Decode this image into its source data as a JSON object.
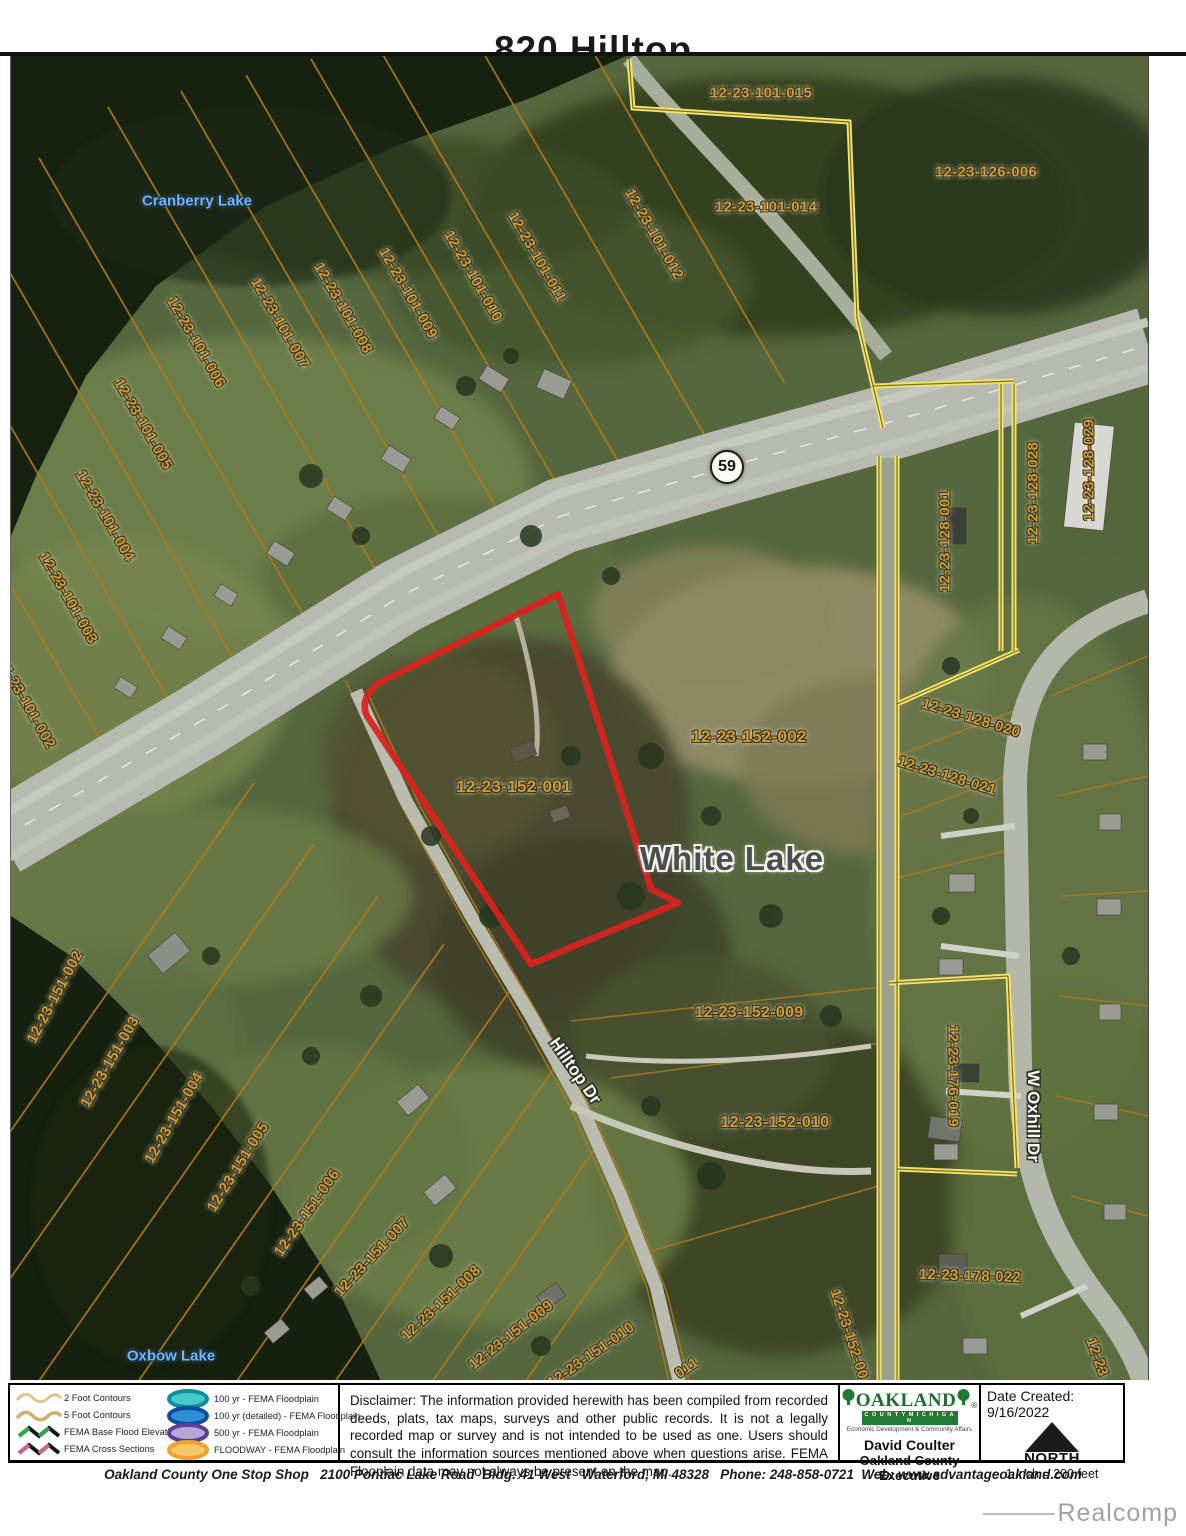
{
  "title": "820 Hilltop",
  "watermark": "Realcomp",
  "colors": {
    "highlight_outline": "#d8231d",
    "parcel_line": "#b07a1d",
    "boundary_yellow": "#f2e26e",
    "parcel_label": "#c89c42",
    "contour_2ft": "#dcc58c",
    "contour_5ft": "#d2b06a",
    "fema_base_flood": "#31a24f",
    "fema_cross_section": "#d06488",
    "floodplain_100yr": "#49c8cc",
    "floodplain_100yr_ring": "#0e8fa0",
    "floodplain_100yr_detailed": "#2f8fd4",
    "floodplain_100yr_detailed_ring": "#0c4da0",
    "floodplain_500yr": "#b4a6d6",
    "floodplain_500yr_ring": "#5a3d99",
    "floodway": "#f7c86a",
    "floodway_ring": "#f0a22c"
  },
  "map": {
    "route_shield": "59",
    "highlighted_parcel": "12-23-152-001",
    "labels": [
      {
        "kind": "parcel",
        "text": "12-23-101-015",
        "x": 750,
        "y": 37,
        "rot": 0
      },
      {
        "kind": "parcel",
        "text": "12-23-101-014",
        "x": 755,
        "y": 151,
        "rot": 0
      },
      {
        "kind": "parcel",
        "text": "12-23-126-006",
        "x": 975,
        "y": 116,
        "rot": 0
      },
      {
        "kind": "parcel",
        "text": "12-23-101-012",
        "x": 643,
        "y": 178,
        "rot": 60
      },
      {
        "kind": "parcel",
        "text": "12-23-101-011",
        "x": 526,
        "y": 201,
        "rot": 60
      },
      {
        "kind": "parcel",
        "text": "12-23-101-010",
        "x": 462,
        "y": 220,
        "rot": 60
      },
      {
        "kind": "parcel",
        "text": "12-23-101-009",
        "x": 397,
        "y": 237,
        "rot": 60
      },
      {
        "kind": "parcel",
        "text": "12-23-101-008",
        "x": 332,
        "y": 252,
        "rot": 60
      },
      {
        "kind": "parcel",
        "text": "12-23-101-007",
        "x": 269,
        "y": 267,
        "rot": 60
      },
      {
        "kind": "parcel",
        "text": "12-23-101-006",
        "x": 185,
        "y": 286,
        "rot": 60
      },
      {
        "kind": "parcel",
        "text": "12-23-101-005",
        "x": 132,
        "y": 368,
        "rot": 60
      },
      {
        "kind": "parcel",
        "text": "12-23-101-004",
        "x": 94,
        "y": 460,
        "rot": 60
      },
      {
        "kind": "parcel",
        "text": "12-23-101-003",
        "x": 57,
        "y": 542,
        "rot": 60
      },
      {
        "kind": "parcel",
        "text": "12-23-101-002",
        "x": 15,
        "y": 647,
        "rot": 60
      },
      {
        "kind": "parcel",
        "text": "12-23-152-001",
        "x": 503,
        "y": 731,
        "rot": 0,
        "size": 17
      },
      {
        "kind": "parcel",
        "text": "12-23-152-002",
        "x": 738,
        "y": 681,
        "rot": 0,
        "size": 17
      },
      {
        "kind": "parcel",
        "text": "12-23-152-009",
        "x": 738,
        "y": 957,
        "rot": 0,
        "size": 16
      },
      {
        "kind": "parcel",
        "text": "12-23-152-010",
        "x": 764,
        "y": 1067,
        "rot": 0,
        "size": 16
      },
      {
        "kind": "parcel",
        "text": "12-23-152-00",
        "x": 838,
        "y": 1278,
        "rot": 72
      },
      {
        "kind": "parcel",
        "text": "12-23-151-002",
        "x": 44,
        "y": 941,
        "rot": -62
      },
      {
        "kind": "parcel",
        "text": "12-23-151-003",
        "x": 99,
        "y": 1006,
        "rot": -60
      },
      {
        "kind": "parcel",
        "text": "12-23-151-004",
        "x": 163,
        "y": 1062,
        "rot": -60
      },
      {
        "kind": "parcel",
        "text": "12-23-151-005",
        "x": 227,
        "y": 1111,
        "rot": -58
      },
      {
        "kind": "parcel",
        "text": "12-23-151-006",
        "x": 296,
        "y": 1157,
        "rot": -55
      },
      {
        "kind": "parcel",
        "text": "12-23-151-007",
        "x": 361,
        "y": 1201,
        "rot": -47
      },
      {
        "kind": "parcel",
        "text": "12-23-151-008",
        "x": 430,
        "y": 1247,
        "rot": -43
      },
      {
        "kind": "parcel",
        "text": "12-23-151-009",
        "x": 500,
        "y": 1279,
        "rot": -38
      },
      {
        "kind": "parcel",
        "text": "12-23-151-010",
        "x": 580,
        "y": 1299,
        "rot": -35
      },
      {
        "kind": "parcel",
        "text": "011",
        "x": 676,
        "y": 1312,
        "rot": -35
      },
      {
        "kind": "parcel",
        "text": "12-23-128-001",
        "x": 934,
        "y": 485,
        "rot": -90
      },
      {
        "kind": "parcel",
        "text": "12-23-128-028",
        "x": 1022,
        "y": 437,
        "rot": -90
      },
      {
        "kind": "parcel",
        "text": "12-23-128-029",
        "x": 1078,
        "y": 414,
        "rot": -90
      },
      {
        "kind": "parcel",
        "text": "12-23-128-020",
        "x": 960,
        "y": 662,
        "rot": 17
      },
      {
        "kind": "parcel",
        "text": "12-23-128-021",
        "x": 936,
        "y": 720,
        "rot": 17
      },
      {
        "kind": "parcel",
        "text": "12-23-176-019",
        "x": 942,
        "y": 1020,
        "rot": 90
      },
      {
        "kind": "parcel",
        "text": "12-23-178-022",
        "x": 959,
        "y": 1220,
        "rot": 2
      },
      {
        "kind": "parcel",
        "text": "12-23",
        "x": 1086,
        "y": 1301,
        "rot": 70
      },
      {
        "kind": "lake",
        "text": "Cranberry Lake",
        "x": 186,
        "y": 145,
        "rot": 0
      },
      {
        "kind": "lake",
        "text": "Oxbow Lake",
        "x": 160,
        "y": 1300,
        "rot": 0
      },
      {
        "kind": "road",
        "text": "Hilltop Dr",
        "x": 564,
        "y": 1015,
        "rot": 55
      },
      {
        "kind": "road",
        "text": "W Oxhill Dr",
        "x": 1022,
        "y": 1060,
        "rot": 90
      },
      {
        "kind": "place",
        "text": "White Lake",
        "x": 721,
        "y": 803,
        "rot": 0,
        "size": 33
      }
    ]
  },
  "legend": {
    "left": [
      {
        "label": "2 Foot Contours",
        "swatch": "contour-2ft"
      },
      {
        "label": "5 Foot Contours",
        "swatch": "contour-5ft"
      },
      {
        "label": "FEMA Base Flood Elevations",
        "swatch": "zigzag-green"
      },
      {
        "label": "FEMA Cross Sections",
        "swatch": "zigzag-pink"
      }
    ],
    "right": [
      {
        "label": "100 yr - FEMA Floodplain",
        "swatch": "ellipse-teal"
      },
      {
        "label": "100 yr (detailed) - FEMA Floodplain",
        "swatch": "ellipse-blue"
      },
      {
        "label": "500 yr - FEMA Floodplain",
        "swatch": "ellipse-purple"
      },
      {
        "label": "FLOODWAY - FEMA Floodplain",
        "swatch": "ellipse-orange"
      }
    ]
  },
  "disclaimer": "Disclaimer:  The information provided herewith has been compiled from recorded deeds, plats, tax maps, surveys and other public records.  It is not a legally recorded map or survey and is not intended to be used as one.  Users should consult the information sources mentioned above when questions arise. FEMA Flooplain data may not always be present on the map.",
  "credits": {
    "logo_name": "OAKLAND",
    "registered_mark": "®",
    "logo_band": "C O U N T Y   M I C H I G A N",
    "logo_tagline": "Economic Development & Community Affairs",
    "executive_name": "David Coulter",
    "executive_title": "Oakland County Executive"
  },
  "info_panel": {
    "date_created": "Date Created: 9/16/2022",
    "north_label": "NORTH",
    "scale_label": "1 inch = 200 feet"
  },
  "footer": "Oakland County One Stop Shop   2100 Pontiac Lake Road  Bldg. 41 West   Waterford, MI 48328   Phone: 248-858-0721  Web: www.advantageoakland.com"
}
